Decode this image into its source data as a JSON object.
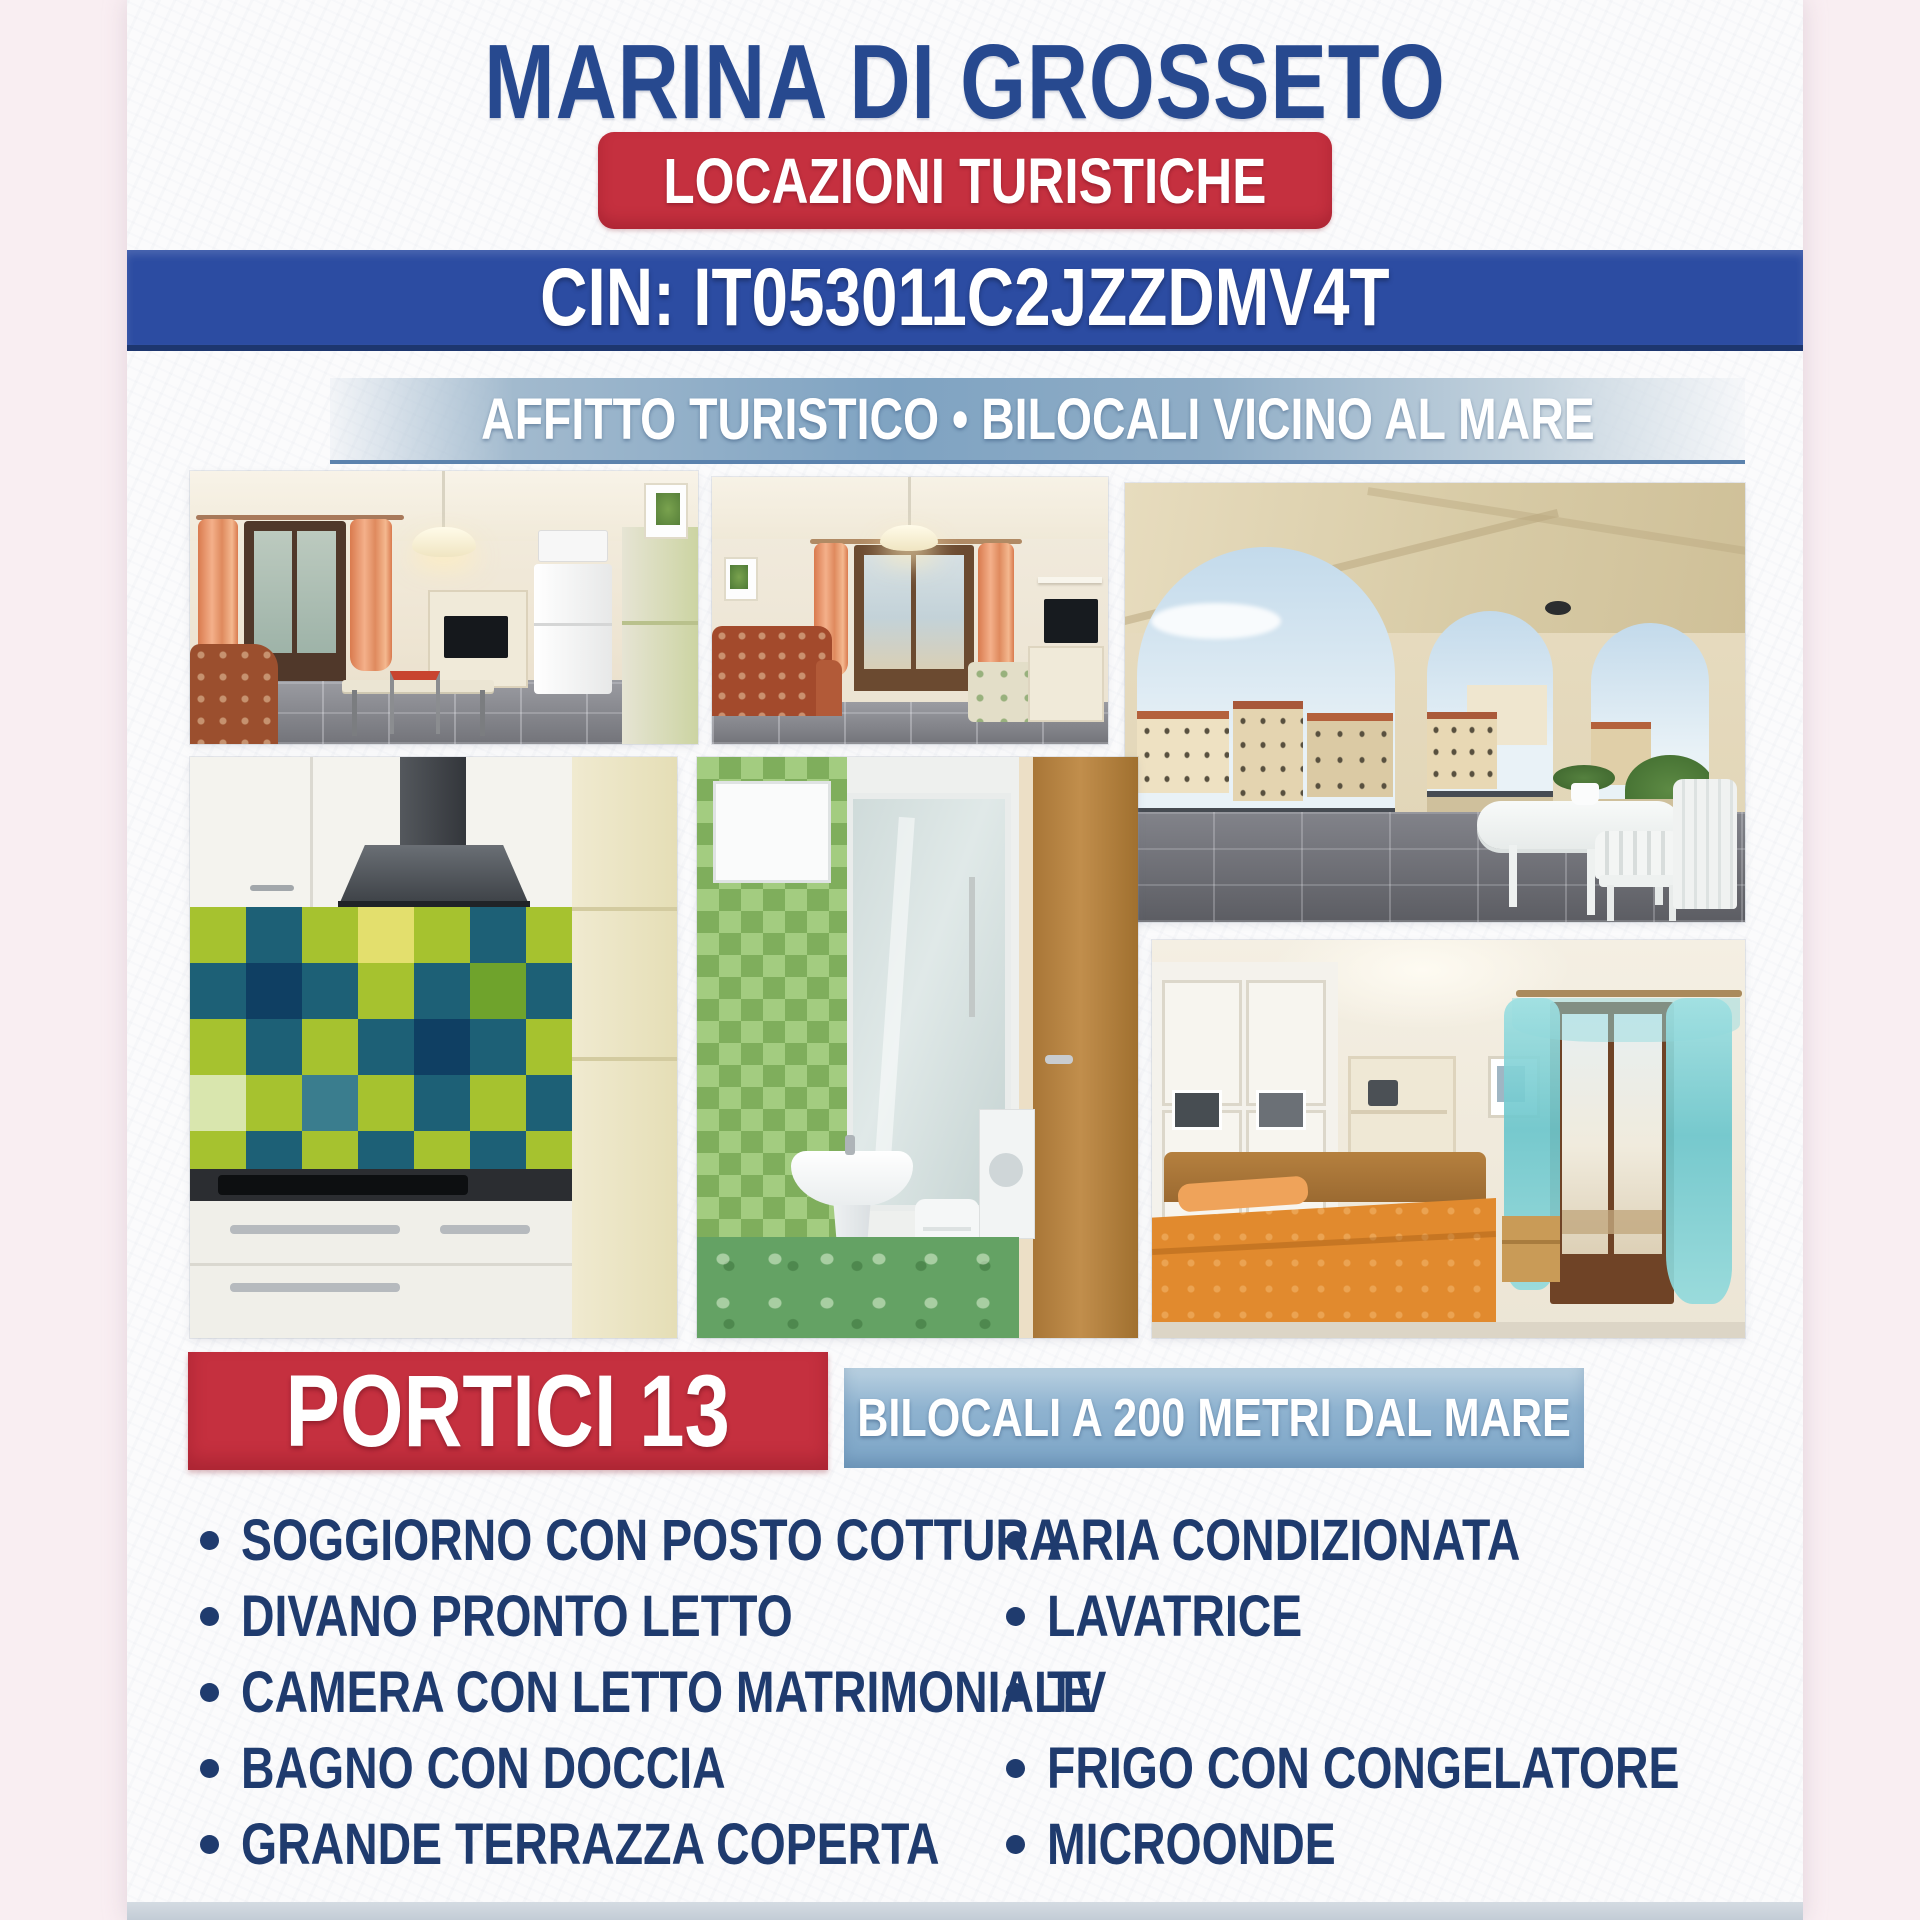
{
  "header": {
    "title": "MARINA DI GROSSETO",
    "badge": "LOCAZIONI TURISTICHE",
    "cin": "CIN: IT053011C2JZZDMV4T",
    "subtitle": "AFFITTO TURISTICO • BILOCALI VICINO AL MARE"
  },
  "listing": {
    "name": "PORTICI 13",
    "tagline": "BILOCALI A 200 METRI DAL MARE"
  },
  "features": {
    "left": [
      "SOGGIORNO CON POSTO COTTURA",
      "DIVANO PRONTO LETTO",
      "CAMERA CON LETTO MATRIMONIALE",
      "BAGNO CON DOCCIA",
      "GRANDE TERRAZZA COPERTA"
    ],
    "right": [
      "ARIA CONDIZIONATA",
      "LAVATRICE",
      "TV",
      "FRIGO CON CONGELATORE",
      "MICROONDE"
    ]
  },
  "photos": [
    {
      "id": "living-room-kitchen",
      "description": "living room with kitchenette, orange curtains, fridge, dining table"
    },
    {
      "id": "living-room-sofa",
      "description": "living room with patterned sofa, orange curtains, balcony door, TV"
    },
    {
      "id": "covered-terrace",
      "description": "covered terrace with arches, town view, white plastic table and chairs"
    },
    {
      "id": "kitchen-tiles",
      "description": "kitchen with green and blue checkered tile backsplash, hood, cooktop"
    },
    {
      "id": "bathroom",
      "description": "bathroom with green mosaic wall, pedestal sink, shower cabin, wooden door"
    },
    {
      "id": "bedroom",
      "description": "bedroom with orange double bed, white wardrobe, turquoise curtains, balcony door"
    }
  ],
  "colors": {
    "title_blue": "#27498f",
    "badge_red": "#c5303f",
    "cin_bar_blue": "#2c4ca2",
    "subtitle_band_blue": "#7fa3c2",
    "tagline_bar_blue": "#8fb3d0",
    "feature_text_navy": "#1f3b6e",
    "page_margin_pink": "#f9eef2"
  }
}
